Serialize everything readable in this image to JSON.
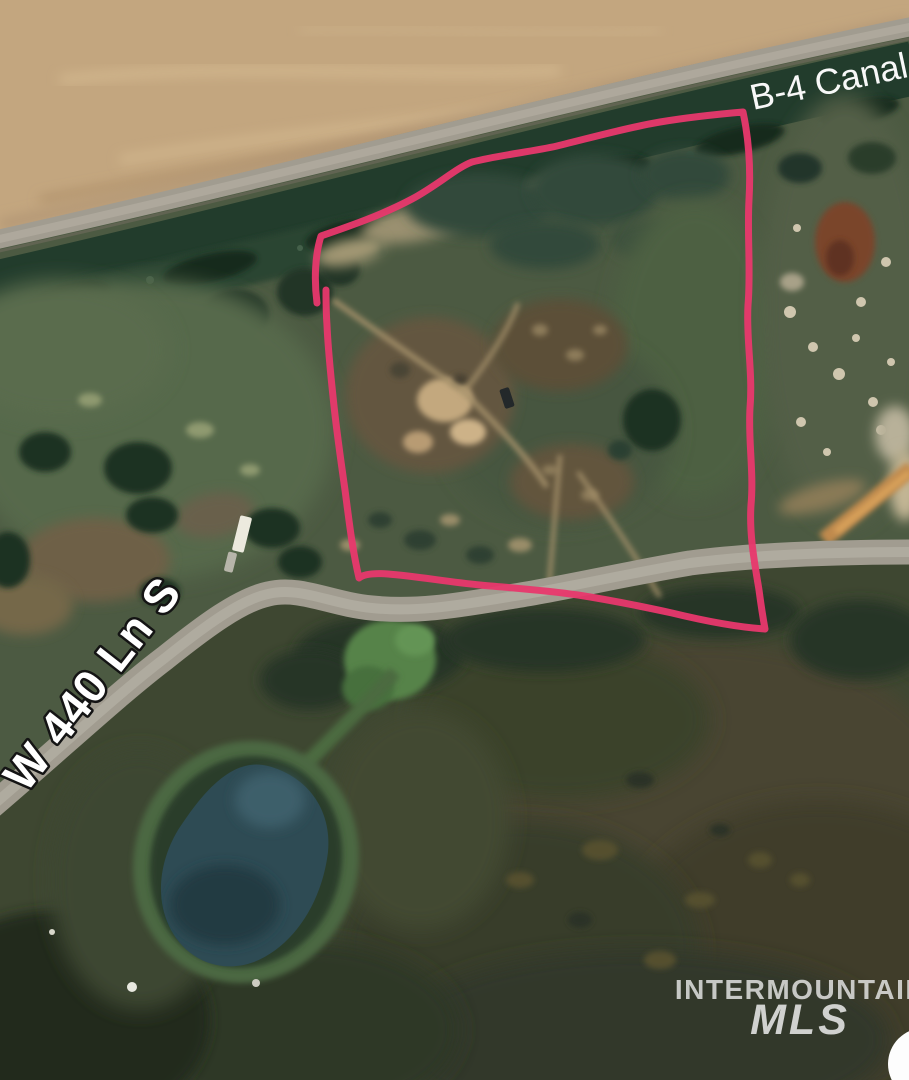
{
  "scene": {
    "description": "Aerial satellite photo of a rural parcel outlined in pink, MLS listing image",
    "canal_label": "B-4 Canal",
    "road_label": "W 440 Ln S",
    "boundary_color": "#e8386d"
  },
  "watermark": {
    "line1": "INTERMOUNTAIN",
    "line2": "MLS",
    "color": "#ececec"
  },
  "palette": {
    "base_green": "#4c5a42",
    "field_tan": "#c3a67f",
    "road_gray": "#a19c90",
    "canal_dark_green": "#223c2c",
    "pasture_green": "#586c4e",
    "property_olive": "#47553f",
    "dirt_brown": "#655741",
    "bright_dirt": "#c3a87e",
    "pond_teal": "#2e4b54",
    "marsh_olive": "#46412e",
    "rust_patch": "#7a452c",
    "orange_dirt": "#c08a4d",
    "label_white": "#ffffff"
  }
}
